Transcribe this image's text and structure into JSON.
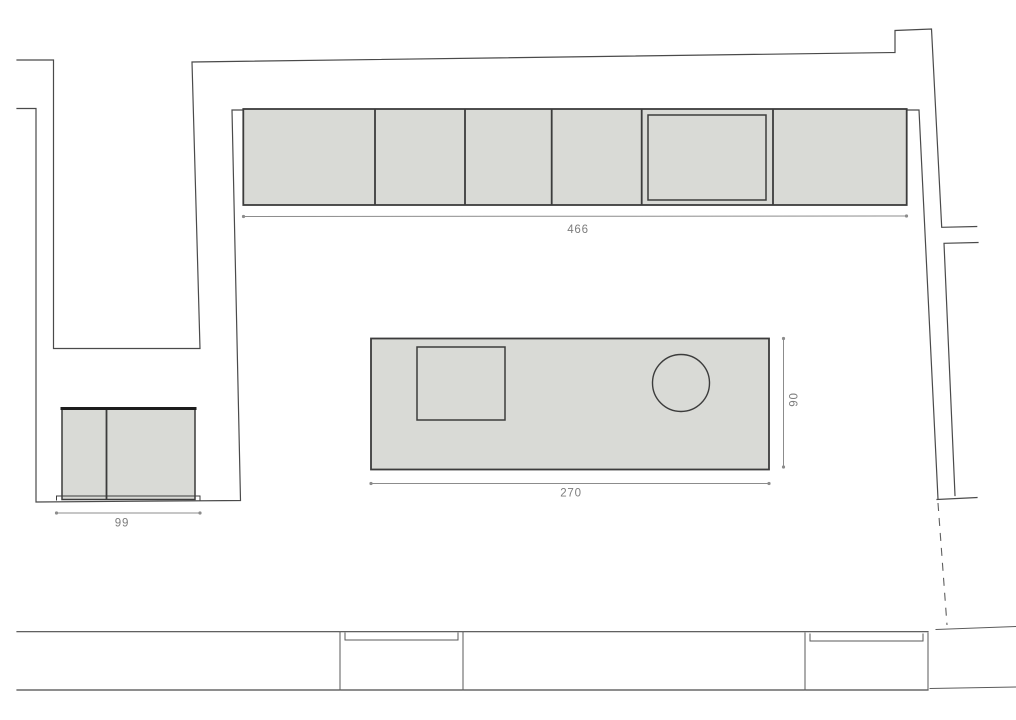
{
  "plan": {
    "type": "kitchen-floor-plan",
    "background_color": "#ffffff",
    "wall_line_color": "#4a4a4a",
    "fixture_border_color": "#3c3c3c",
    "fixture_fill_color": "#d9dad6",
    "dimension_color": "#8c8c8c",
    "dimensions": {
      "upper_cabinet_run": "466",
      "island_length": "270",
      "island_depth": "90",
      "sideboard_width": "99"
    },
    "counts": {
      "upper_cabinet_units": 6,
      "windows": 2,
      "island_fixtures": [
        "cooktop",
        "sink"
      ]
    }
  }
}
